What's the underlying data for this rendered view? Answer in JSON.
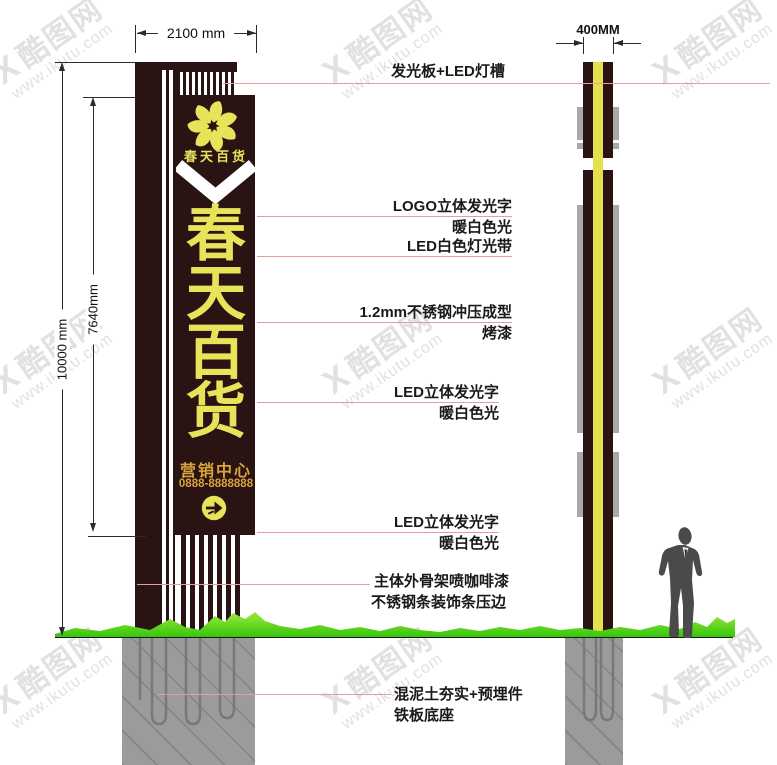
{
  "dimensions": {
    "front_width": "2100 mm",
    "side_width": "400MM",
    "total_height": "10000 mm",
    "panel_height": "7640mm"
  },
  "sign": {
    "logo_name": "春天百货",
    "chars": [
      "春",
      "天",
      "百",
      "货"
    ],
    "dept": "营销中心",
    "phone": "0888-8888888"
  },
  "callouts": [
    {
      "text": "发光板+LED灯槽",
      "sub": ""
    },
    {
      "text": "LOGO立体发光字",
      "sub": "暖白色光"
    },
    {
      "text": "LED白色灯光带",
      "sub": ""
    },
    {
      "text": "1.2mm不锈钢冲压成型",
      "sub": "烤漆"
    },
    {
      "text": "LED立体发光字",
      "sub": "暖白色光"
    },
    {
      "text": "LED立体发光字",
      "sub": "暖白色光"
    },
    {
      "text": "主体外骨架喷咖啡漆",
      "sub": "不锈钢条装饰条压边"
    },
    {
      "text": "混泥土夯实+预埋件",
      "sub": "铁板底座"
    }
  ],
  "watermark": {
    "mark": "X",
    "logo": "酷图网",
    "url": "www.ikutu.com"
  },
  "colors": {
    "panel": "#2a1313",
    "yellow": "#e7e45a",
    "gold": "#d9a33c",
    "grass": "#52d715",
    "callout_line": "#ec9a9a",
    "foundation": "#9b9b9b",
    "ground": "#161616"
  }
}
